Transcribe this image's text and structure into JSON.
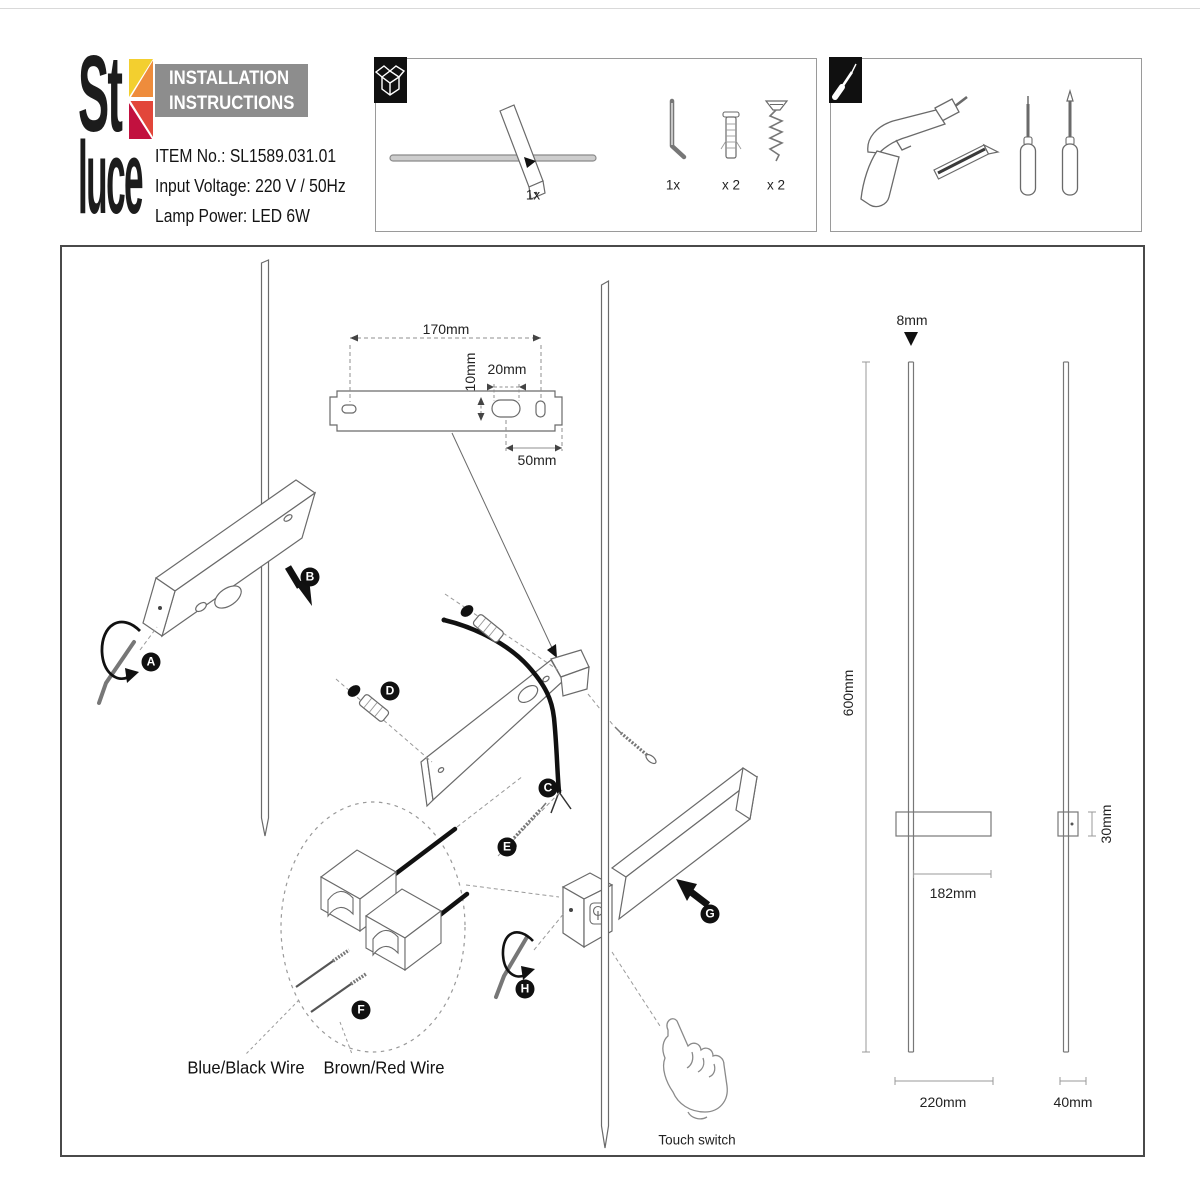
{
  "brand": {
    "logo_top": "St",
    "logo_bottom": "luce"
  },
  "header": {
    "title_line1": "INSTALLATION",
    "title_line2": "INSTRUCTIONS",
    "item_no": "ITEM No.: SL1589.031.01",
    "input_voltage": "Input Voltage: 220 V / 50Hz",
    "lamp_power": "Lamp Power: LED 6W"
  },
  "package_panel": {
    "lamp_qty": "1x",
    "hex_key_qty": "1x",
    "wall_plug_qty": "x 2",
    "screw_qty": "x 2"
  },
  "diagram": {
    "step_labels": [
      "A",
      "B",
      "C",
      "D",
      "E",
      "F",
      "G",
      "H"
    ],
    "bracket_dims": {
      "length": "170mm",
      "offset": "10mm",
      "hole_width": "20mm",
      "hole_spacing": "50mm"
    },
    "wires": {
      "neutral": "Blue/Black Wire",
      "live": "Brown/Red Wire"
    },
    "touch_switch_label": "Touch switch",
    "product_dims": {
      "rod_diameter": "8mm",
      "height": "600mm",
      "body_length": "182mm",
      "body_depth": "30mm",
      "body_width": "220mm",
      "side_depth": "40mm"
    }
  },
  "colors": {
    "accent_yellow": "#f3cf2f",
    "accent_orange": "#ee8c3c",
    "accent_red": "#e2463a",
    "accent_crimson": "#c2113f",
    "header_bg": "#8d8d8d",
    "line_dark": "#4a4a4a",
    "line_art": "#666666"
  }
}
